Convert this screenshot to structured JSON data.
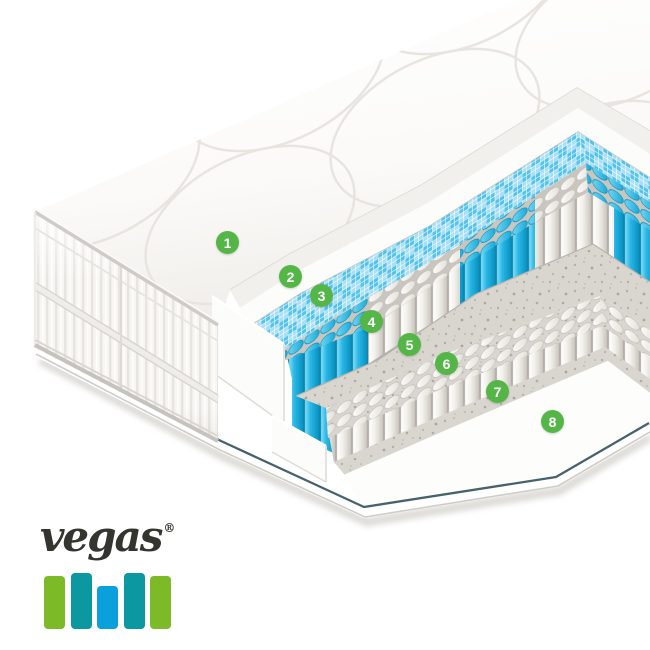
{
  "badges": [
    {
      "number": "1"
    },
    {
      "number": "2"
    },
    {
      "number": "3"
    },
    {
      "number": "4"
    },
    {
      "number": "5"
    },
    {
      "number": "6"
    },
    {
      "number": "7"
    },
    {
      "number": "8"
    }
  ],
  "colors": {
    "badge_green": "#55b648",
    "spring_blue": "#2eb9e6",
    "mesh_blue": "#54c3ec",
    "felt_gray": "#d9d6d0",
    "base_pinstripe": "#47626d",
    "logo_text": "#35352f"
  },
  "logo": {
    "text": "vegas",
    "registered": "®",
    "bars": [
      {
        "color": "#7cba28"
      },
      {
        "color": "#0b98a0"
      },
      {
        "color": "#09a0dc"
      },
      {
        "color": "#0b98a0"
      },
      {
        "color": "#7cba28"
      }
    ]
  }
}
